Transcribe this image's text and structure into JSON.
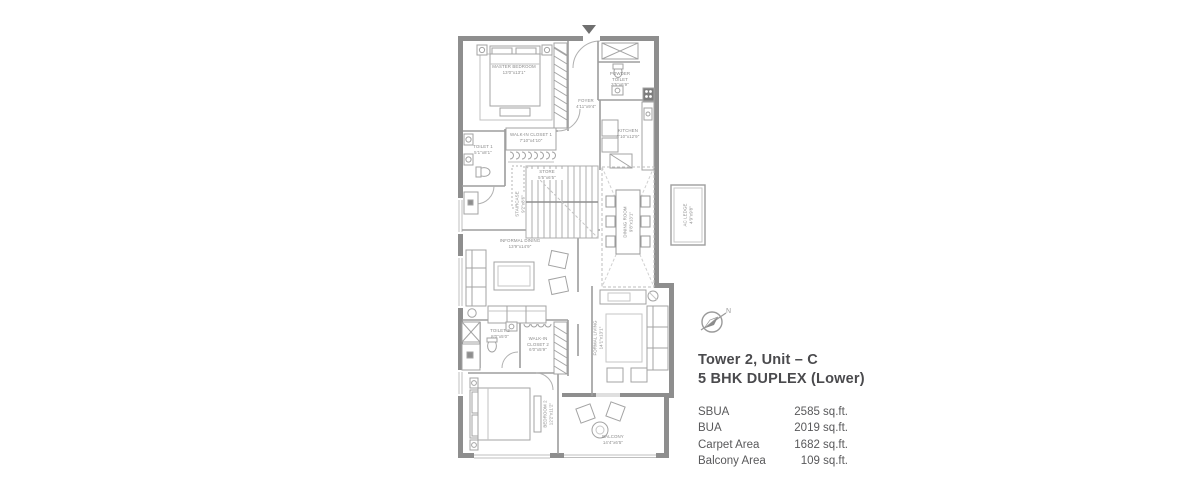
{
  "colors": {
    "wall": "#8e8e8e",
    "thin_line": "#a8a8a8",
    "label_text": "#8a8a8a",
    "title_text": "#4a4a4d"
  },
  "compass": {
    "icon": "compass-north",
    "label": "N"
  },
  "title": {
    "line1": "Tower 2, Unit – C",
    "line2": "5 BHK DUPLEX (Lower)"
  },
  "areas": {
    "rows": [
      {
        "label": "SBUA",
        "value": "2585 sq.ft."
      },
      {
        "label": "BUA",
        "value": "2019 sq.ft."
      },
      {
        "label": "Carpet Area",
        "value": "1682 sq.ft."
      },
      {
        "label": "Balcony Area",
        "value": "109 sq.ft."
      }
    ]
  },
  "floorplan": {
    "rooms": [
      {
        "name": "MASTER BEDROOM",
        "dims": "13'0\"x13'1\""
      },
      {
        "name": "FOYER",
        "dims": "4'11\"x9'4\""
      },
      {
        "name": "POWDER TOILET",
        "dims": "3'5\"x6'9\""
      },
      {
        "name": "KITCHEN",
        "dims": "8'10\"x12'9\""
      },
      {
        "name": "WALK-IN CLOSET 1",
        "dims": "7'10\"x4'10\""
      },
      {
        "name": "TOILET 1",
        "dims": "5'1\"x8'1\""
      },
      {
        "name": "STORE",
        "dims": "5'5\"x6'5\""
      },
      {
        "name": "STAIRCASE",
        "dims": "9'2\"x8'6\""
      },
      {
        "name": "DINING ROOM",
        "dims": "9'8\"x13'1\""
      },
      {
        "name": "AC LEDGE",
        "dims": "4'9\"x9'8\""
      },
      {
        "name": "INFORMAL DINING",
        "dims": "13'9\"x14'9\""
      },
      {
        "name": "TOILET 2",
        "dims": "8'0\"x5'0\""
      },
      {
        "name": "WALK-IN CLOSET 2",
        "dims": "6'0\"x5'9\""
      },
      {
        "name": "FORMAL LIVING",
        "dims": "14'1\"x13'1\""
      },
      {
        "name": "BEDROOM 2",
        "dims": "12'2\"x11'2\""
      },
      {
        "name": "BALCONY",
        "dims": "14'4\"x6'5\""
      }
    ]
  }
}
